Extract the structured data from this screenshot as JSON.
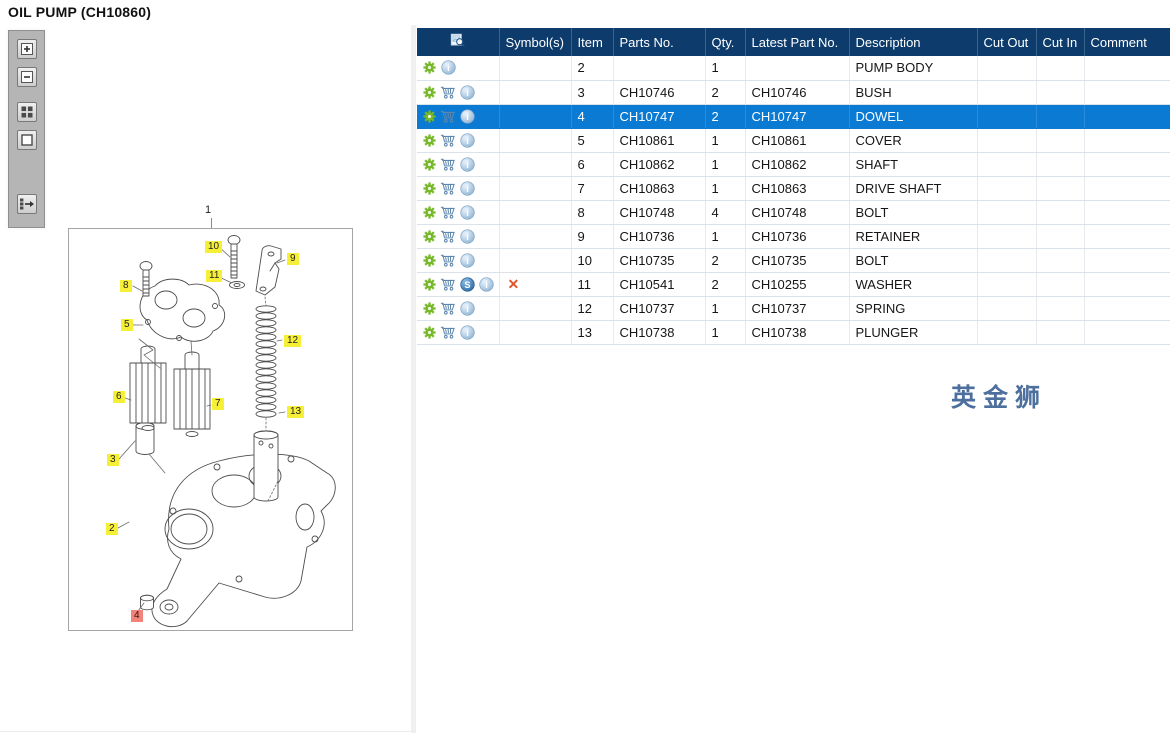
{
  "page": {
    "title": "OIL PUMP (CH10860)"
  },
  "colors": {
    "header_bg": "#0d3c6c",
    "selected_bg": "#0b7ad3",
    "callout_yellow": "#f6ef38",
    "callout_highlight": "#f0837a",
    "watermark": "#4d6f9d",
    "gear_green": "#76b82a",
    "x_red": "#e2552b"
  },
  "toolbar": {
    "buttons": [
      {
        "name": "zoom-in"
      },
      {
        "name": "zoom-out"
      },
      {
        "name": "tile-view"
      },
      {
        "name": "single-view"
      },
      {
        "name": "toggle-parts-list"
      }
    ]
  },
  "diagram": {
    "figure_label": "1",
    "callouts": [
      {
        "label": "10",
        "x": 205,
        "y": 241,
        "highlight": false
      },
      {
        "label": "9",
        "x": 287,
        "y": 253,
        "highlight": false
      },
      {
        "label": "11",
        "x": 206,
        "y": 270,
        "highlight": false
      },
      {
        "label": "8",
        "x": 120,
        "y": 280,
        "highlight": false
      },
      {
        "label": "5",
        "x": 121,
        "y": 319,
        "highlight": false
      },
      {
        "label": "12",
        "x": 284,
        "y": 335,
        "highlight": false
      },
      {
        "label": "6",
        "x": 113,
        "y": 391,
        "highlight": false
      },
      {
        "label": "7",
        "x": 212,
        "y": 398,
        "highlight": false
      },
      {
        "label": "13",
        "x": 287,
        "y": 406,
        "highlight": false
      },
      {
        "label": "3",
        "x": 107,
        "y": 454,
        "highlight": false
      },
      {
        "label": "2",
        "x": 106,
        "y": 523,
        "highlight": false
      },
      {
        "label": "4",
        "x": 131,
        "y": 610,
        "highlight": true
      }
    ]
  },
  "table": {
    "columns": [
      {
        "key": "actions",
        "label": "",
        "icon": "preview",
        "width": 82
      },
      {
        "key": "symbols",
        "label": "Symbol(s)",
        "width": 72
      },
      {
        "key": "item",
        "label": "Item",
        "width": 42
      },
      {
        "key": "parts_no",
        "label": "Parts No.",
        "width": 92
      },
      {
        "key": "qty",
        "label": "Qty.",
        "width": 40
      },
      {
        "key": "latest_part_no",
        "label": "Latest Part No.",
        "width": 104
      },
      {
        "key": "description",
        "label": "Description",
        "width": 128
      },
      {
        "key": "cut_out",
        "label": "Cut Out",
        "width": 59
      },
      {
        "key": "cut_in",
        "label": "Cut In",
        "width": 48
      },
      {
        "key": "comment",
        "label": "Comment",
        "width": 86
      }
    ],
    "rows": [
      {
        "icons": [
          "gear",
          "info"
        ],
        "symbols": "",
        "item": "2",
        "parts_no": "",
        "qty": "1",
        "latest_part_no": "",
        "description": "PUMP BODY",
        "cut_out": "",
        "cut_in": "",
        "comment": "",
        "selected": false
      },
      {
        "icons": [
          "gear",
          "cart",
          "info"
        ],
        "symbols": "",
        "item": "3",
        "parts_no": "CH10746",
        "qty": "2",
        "latest_part_no": "CH10746",
        "description": "BUSH",
        "cut_out": "",
        "cut_in": "",
        "comment": "",
        "selected": false
      },
      {
        "icons": [
          "gear",
          "cart",
          "info"
        ],
        "symbols": "",
        "item": "4",
        "parts_no": "CH10747",
        "qty": "2",
        "latest_part_no": "CH10747",
        "description": "DOWEL",
        "cut_out": "",
        "cut_in": "",
        "comment": "",
        "selected": true
      },
      {
        "icons": [
          "gear",
          "cart",
          "info"
        ],
        "symbols": "",
        "item": "5",
        "parts_no": "CH10861",
        "qty": "1",
        "latest_part_no": "CH10861",
        "description": "COVER",
        "cut_out": "",
        "cut_in": "",
        "comment": "",
        "selected": false
      },
      {
        "icons": [
          "gear",
          "cart",
          "info"
        ],
        "symbols": "",
        "item": "6",
        "parts_no": "CH10862",
        "qty": "1",
        "latest_part_no": "CH10862",
        "description": "SHAFT",
        "cut_out": "",
        "cut_in": "",
        "comment": "",
        "selected": false
      },
      {
        "icons": [
          "gear",
          "cart",
          "info"
        ],
        "symbols": "",
        "item": "7",
        "parts_no": "CH10863",
        "qty": "1",
        "latest_part_no": "CH10863",
        "description": "DRIVE SHAFT",
        "cut_out": "",
        "cut_in": "",
        "comment": "",
        "selected": false
      },
      {
        "icons": [
          "gear",
          "cart",
          "info"
        ],
        "symbols": "",
        "item": "8",
        "parts_no": "CH10748",
        "qty": "4",
        "latest_part_no": "CH10748",
        "description": "BOLT",
        "cut_out": "",
        "cut_in": "",
        "comment": "",
        "selected": false
      },
      {
        "icons": [
          "gear",
          "cart",
          "info"
        ],
        "symbols": "",
        "item": "9",
        "parts_no": "CH10736",
        "qty": "1",
        "latest_part_no": "CH10736",
        "description": "RETAINER",
        "cut_out": "",
        "cut_in": "",
        "comment": "",
        "selected": false
      },
      {
        "icons": [
          "gear",
          "cart",
          "info"
        ],
        "symbols": "",
        "item": "10",
        "parts_no": "CH10735",
        "qty": "2",
        "latest_part_no": "CH10735",
        "description": "BOLT",
        "cut_out": "",
        "cut_in": "",
        "comment": "",
        "selected": false
      },
      {
        "icons": [
          "gear",
          "cart",
          "substitute",
          "info"
        ],
        "symbols": "✕",
        "item": "11",
        "parts_no": "CH10541",
        "qty": "2",
        "latest_part_no": "CH10255",
        "description": "WASHER",
        "cut_out": "",
        "cut_in": "",
        "comment": "",
        "selected": false
      },
      {
        "icons": [
          "gear",
          "cart",
          "info"
        ],
        "symbols": "",
        "item": "12",
        "parts_no": "CH10737",
        "qty": "1",
        "latest_part_no": "CH10737",
        "description": "SPRING",
        "cut_out": "",
        "cut_in": "",
        "comment": "",
        "selected": false
      },
      {
        "icons": [
          "gear",
          "cart",
          "info"
        ],
        "symbols": "",
        "item": "13",
        "parts_no": "CH10738",
        "qty": "1",
        "latest_part_no": "CH10738",
        "description": "PLUNGER",
        "cut_out": "",
        "cut_in": "",
        "comment": "",
        "selected": false
      }
    ]
  },
  "watermark": {
    "text": "英金狮"
  }
}
